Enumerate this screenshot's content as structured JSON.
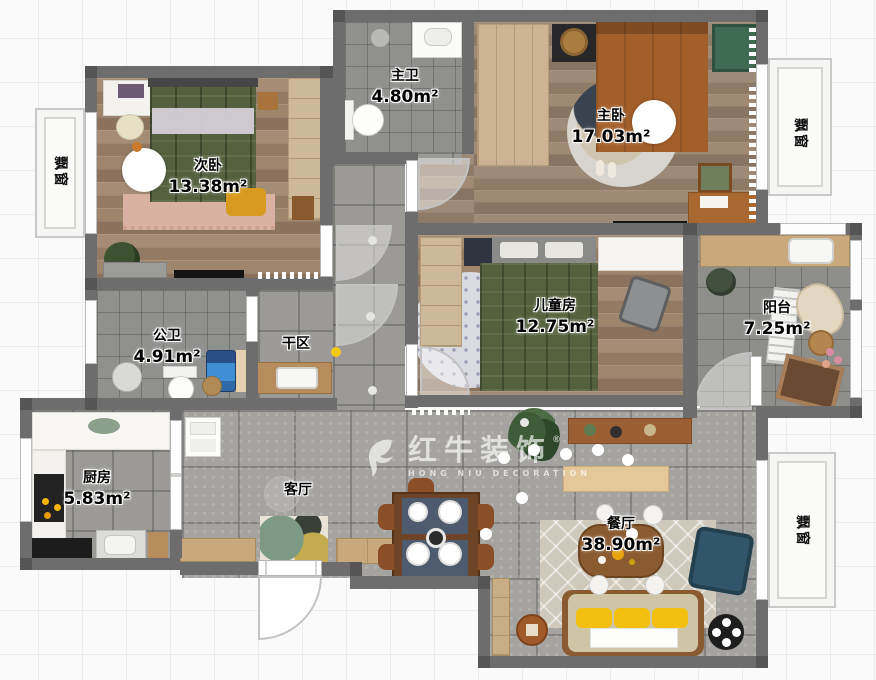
{
  "watermark": {
    "brand": "红牛装饰",
    "sub": "HONG NIU DECORATION",
    "reg": "®"
  },
  "rooms": {
    "zhuwei": {
      "name": "主卫",
      "area": "4.80m²"
    },
    "zhuwo": {
      "name": "主卧",
      "area": "17.03m²"
    },
    "ciwo": {
      "name": "次卧",
      "area": "13.38m²"
    },
    "ertong": {
      "name": "儿童房",
      "area": "12.75m²"
    },
    "yangtai": {
      "name": "阳台",
      "area": "7.25m²"
    },
    "gongwei": {
      "name": "公卫",
      "area": "4.91m²"
    },
    "ganqu": {
      "name": "干区"
    },
    "chufang": {
      "name": "厨房",
      "area": "5.83m²"
    },
    "keting": {
      "name": "客厅"
    },
    "canting": {
      "name": "餐厅",
      "area": "38.90m²"
    },
    "bay_left": {
      "name": "飘窗"
    },
    "bay_right": {
      "name": "飘窗"
    },
    "bay_bottom": {
      "name": "飘窗"
    }
  },
  "colors": {
    "wall": "#6d6d6d",
    "wood_floor": "#9c8671",
    "tile_floor": "#a5a3a0",
    "accent_bed_green": "#5a6540",
    "accent_bed_brown": "#a35f2a",
    "accent_sofa_navy": "#31566b",
    "accent_cushion_yellow": "#f2c10f"
  }
}
